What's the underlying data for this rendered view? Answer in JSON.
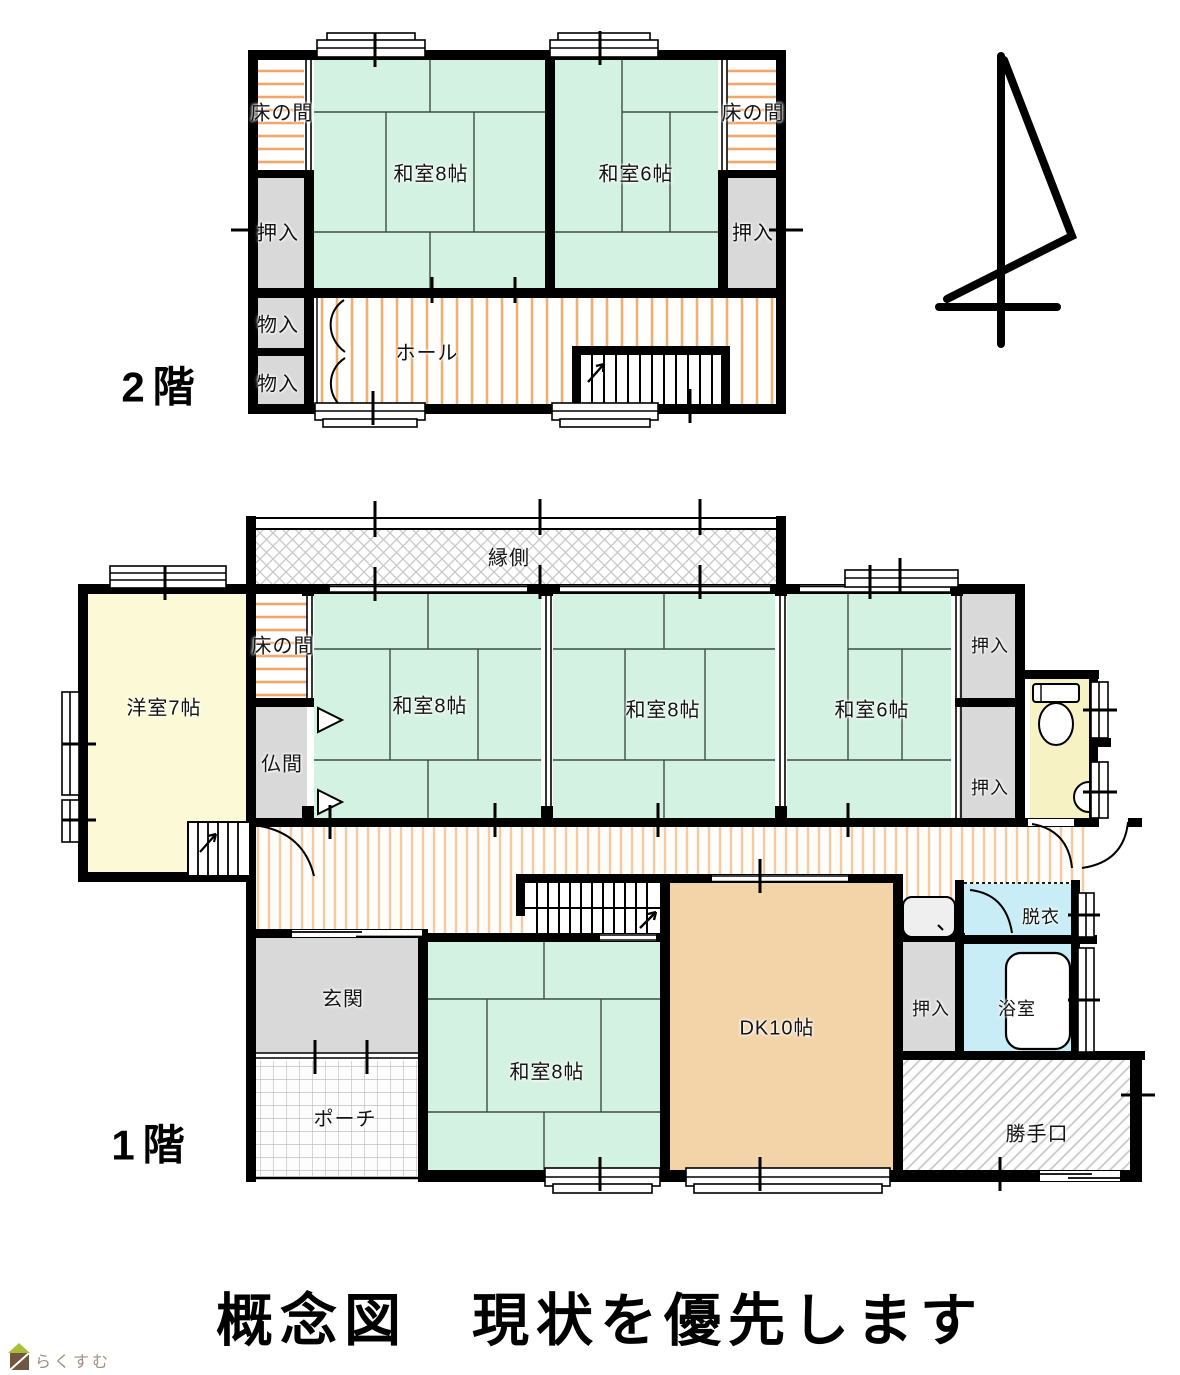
{
  "title": "概念図　現状を優先します",
  "floor2": {
    "name": "2階",
    "rooms": {
      "tokonoma_left": "床の間",
      "tokonoma_right": "床の間",
      "washitsu8": "和室8帖",
      "washitsu6": "和室6帖",
      "oshiire_left": "押入",
      "oshiire_right": "押入",
      "monoire_upper": "物入",
      "monoire_lower": "物入",
      "hall": "ホール"
    }
  },
  "floor1": {
    "name": "1階",
    "rooms": {
      "engawa": "縁側",
      "tokonoma": "床の間",
      "yoshitsu7": "洋室7帖",
      "butsuma": "仏間",
      "washitsu8_left": "和室8帖",
      "washitsu8_center": "和室8帖",
      "washitsu6": "和室6帖",
      "oshiire_upper": "押入",
      "oshiire_lower": "押入",
      "oshiire_dk": "押入",
      "datsui": "脱衣",
      "yokushitsu": "浴室",
      "dk": "DK10帖",
      "genkan": "玄関",
      "porch": "ポーチ",
      "washitsu8_south": "和室8帖",
      "katteguchi": "勝手口"
    }
  },
  "logo": {
    "text": "らくすむ"
  },
  "colors": {
    "tatami_green": "#d4f2e2",
    "closet_gray": "#d9d9d9",
    "western_yellow": "#fcfad6",
    "toilet_yellow": "#f7f2c4",
    "dk_tan": "#f2d4a8",
    "bath_blue": "#c9edf6",
    "hall_stripe": "#eeb06e",
    "corridor_stripe": "#f2cba4",
    "wall_black": "#000000",
    "logo_green": "#a9bf3a",
    "logo_brown": "#6f5741",
    "logo_text": "#a09181"
  }
}
